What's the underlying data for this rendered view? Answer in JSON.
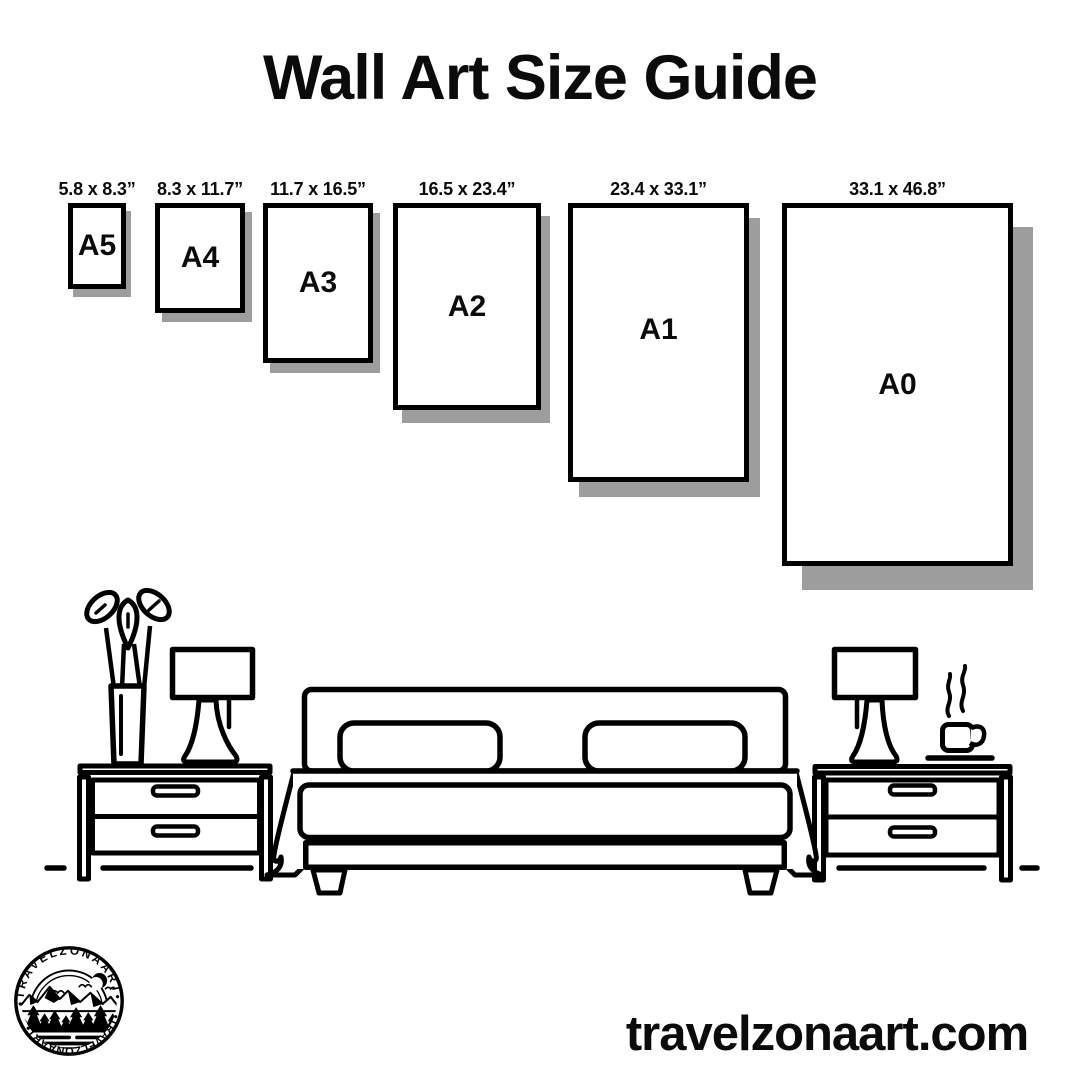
{
  "page": {
    "background": "#ffffff",
    "ink": "#000000",
    "shadow_color": "#9d9d9d"
  },
  "title": "Wall Art Size Guide",
  "size_guide": {
    "frames": [
      {
        "name": "A5",
        "dimensions": "5.8 x 8.3”",
        "box": {
          "left": 68,
          "top": 203,
          "width": 58,
          "height": 86
        },
        "shadow_offset": [
          5,
          8
        ]
      },
      {
        "name": "A4",
        "dimensions": "8.3 x 11.7”",
        "box": {
          "left": 155,
          "top": 203,
          "width": 90,
          "height": 110
        },
        "shadow_offset": [
          7,
          9
        ]
      },
      {
        "name": "A3",
        "dimensions": "11.7 x 16.5”",
        "box": {
          "left": 263,
          "top": 203,
          "width": 110,
          "height": 160
        },
        "shadow_offset": [
          7,
          10
        ]
      },
      {
        "name": "A2",
        "dimensions": "16.5 x 23.4”",
        "box": {
          "left": 393,
          "top": 203,
          "width": 148,
          "height": 207
        },
        "shadow_offset": [
          9,
          13
        ]
      },
      {
        "name": "A1",
        "dimensions": "23.4 x 33.1”",
        "box": {
          "left": 568,
          "top": 203,
          "width": 181,
          "height": 279
        },
        "shadow_offset": [
          11,
          15
        ]
      },
      {
        "name": "A0",
        "dimensions": "33.1 x 46.8”",
        "box": {
          "left": 782,
          "top": 203,
          "width": 231,
          "height": 363
        },
        "shadow_offset": [
          20,
          24
        ]
      }
    ]
  },
  "logo": {
    "arc_text_top": "•TRAVELZONAART•",
    "arc_text_bottom": "•TRAVELZONAART•"
  },
  "website": "travelzonaart.com"
}
